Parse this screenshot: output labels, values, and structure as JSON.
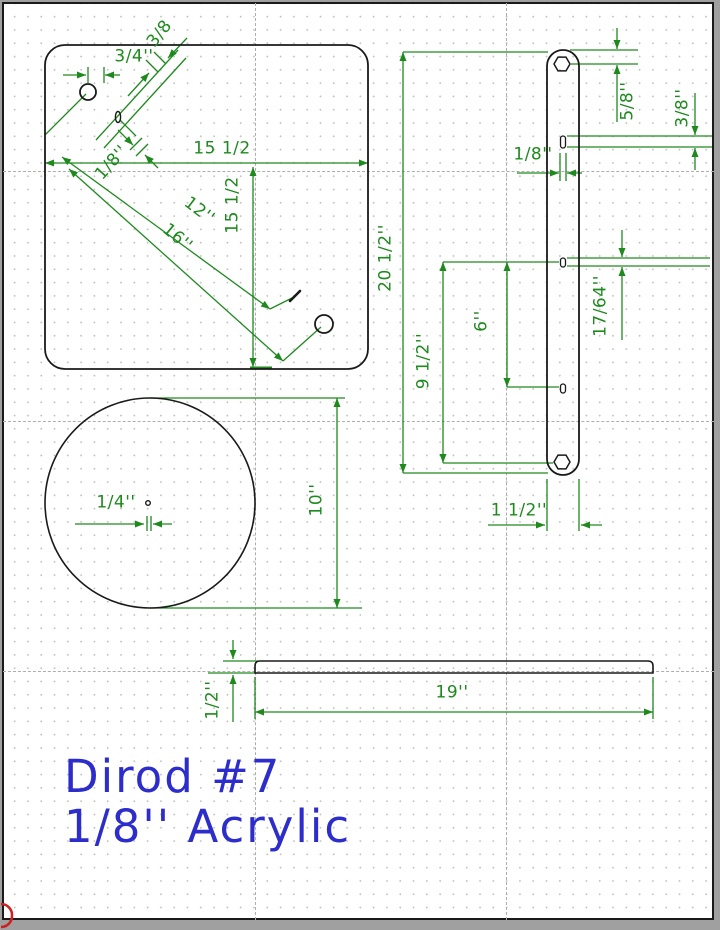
{
  "drawing_title": {
    "line1": "Dirod #7",
    "line2": "1/8'' Acrylic"
  },
  "colors": {
    "dimension_green": "#1e8a1e",
    "outline_black": "#1a1a1a",
    "title_blue": "#2d2dcb",
    "grid_dot_gray": "#c2c2c2",
    "guide_dash_gray": "#aeaeae",
    "window_chrome_gray": "#a0a0a0",
    "corner_mark_red": "#cc2222",
    "page_white": "#ffffff"
  },
  "dimensions": {
    "plate": {
      "hole_offset": "3/4''",
      "slot_diag": "3/8",
      "width": "15 1/2",
      "height": "15 1/2",
      "slot_width": "1/8''",
      "diag_to_slot": "12''",
      "diag_to_hole": "16''"
    },
    "bar": {
      "length": "20 1/2''",
      "top_hole_offset": "5/8''",
      "top_slot_length": "3/8''",
      "slot_width": "1/8''",
      "mid_slot_length": "17/64''",
      "hole_span": "9 1/2''",
      "slot_span": "6''",
      "width": "1 1/2''"
    },
    "disc": {
      "center_hole": "1/4''",
      "diameter": "10''"
    },
    "strip": {
      "length": "19''",
      "thickness": "1/2''"
    }
  }
}
